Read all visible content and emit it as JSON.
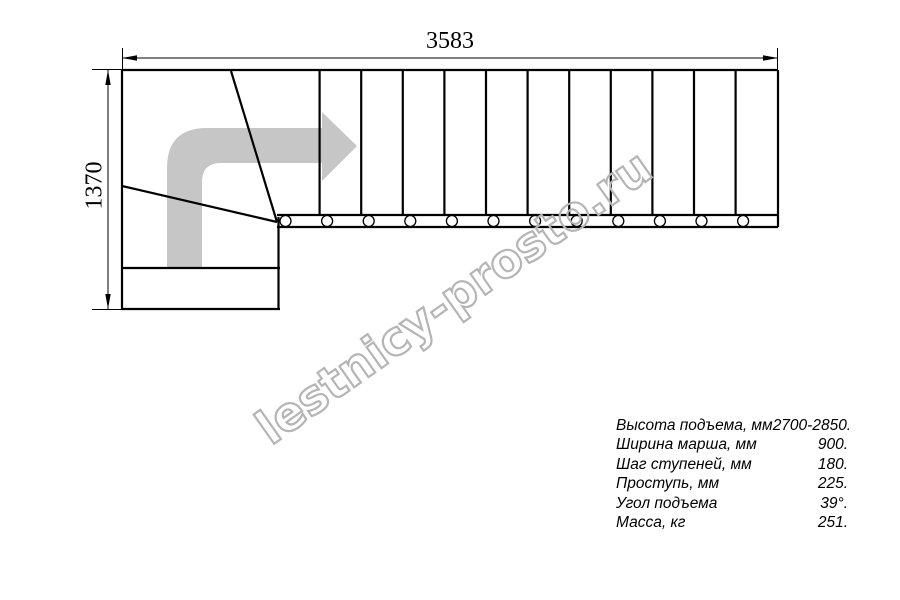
{
  "drawing": {
    "width_dim": "3583",
    "height_dim": "1370",
    "watermark": "lestnicy-prosto.ru",
    "colors": {
      "line": "#000000",
      "arrow": "#c6c6c6",
      "watermark": "#b5b5b5"
    }
  },
  "specs": {
    "rows": [
      {
        "label": "Высота подъема, мм",
        "value": "2700-2850."
      },
      {
        "label": "Ширина марша, мм",
        "value": "900."
      },
      {
        "label": "Шаг ступеней, мм",
        "value": "180."
      },
      {
        "label": "Проступь, мм",
        "value": "225."
      },
      {
        "label": "Угол подъема",
        "value": "39°."
      },
      {
        "label": "Масса, кг",
        "value": "251."
      }
    ]
  }
}
